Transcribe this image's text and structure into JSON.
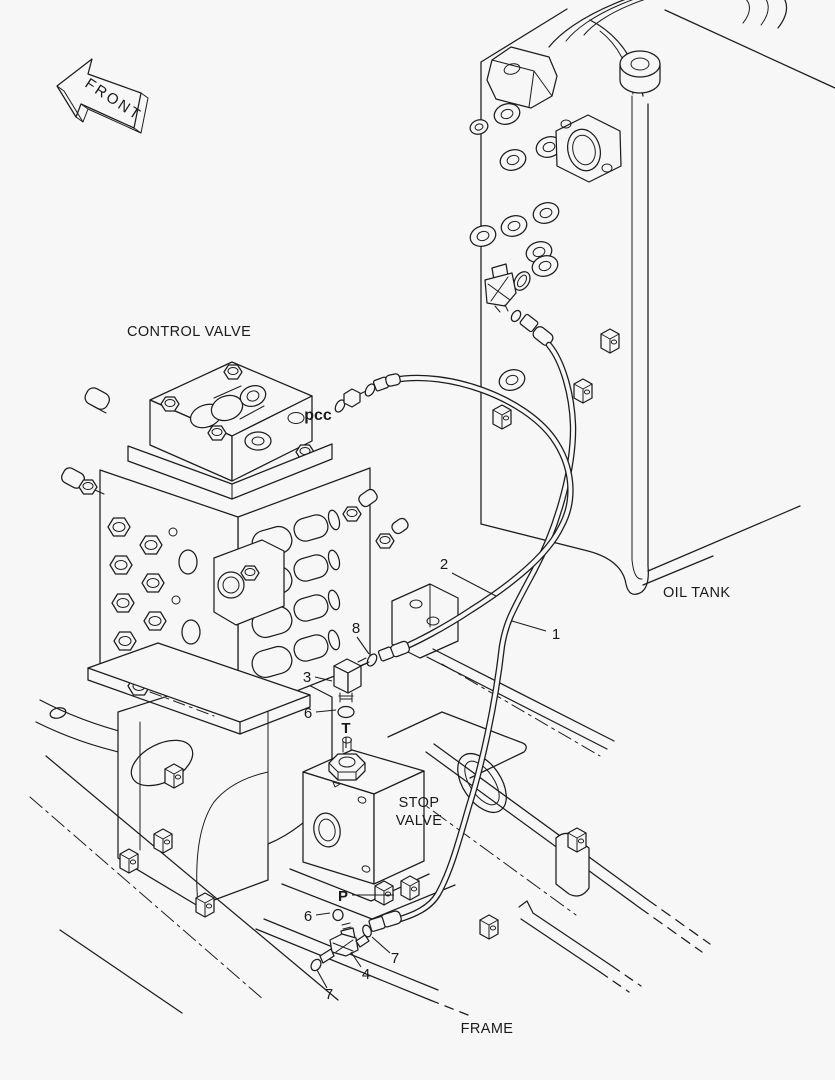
{
  "colors": {
    "background": "#f7f7f7",
    "line": "#1d1d1d",
    "text": "#1a1a1a"
  },
  "front_marker": {
    "label": "FRONT"
  },
  "part_labels": {
    "control_valve": "CONTROL VALVE",
    "oil_tank": "OIL TANK",
    "stop_valve": [
      "STOP",
      "VALVE"
    ],
    "frame": "FRAME"
  },
  "port_markers": {
    "pcc": "pcc",
    "t_port": "T",
    "p_port": "P"
  },
  "callouts": [
    {
      "label": "1",
      "part": "hose-stop-valve-to-oil-tank"
    },
    {
      "label": "2",
      "part": "hose-pcc-to-stop-valve"
    },
    {
      "label": "3",
      "part": "elbow-fitting-t-port"
    },
    {
      "label": "4",
      "part": "tee-fitting-p-port"
    },
    {
      "label": "6",
      "part": "o-ring-t-port"
    },
    {
      "label": "6",
      "part": "o-ring-p-port"
    },
    {
      "label": "7",
      "part": "o-ring-tee-left"
    },
    {
      "label": "7",
      "part": "o-ring-tee-hose"
    },
    {
      "label": "8",
      "part": "o-ring-elbow"
    }
  ]
}
